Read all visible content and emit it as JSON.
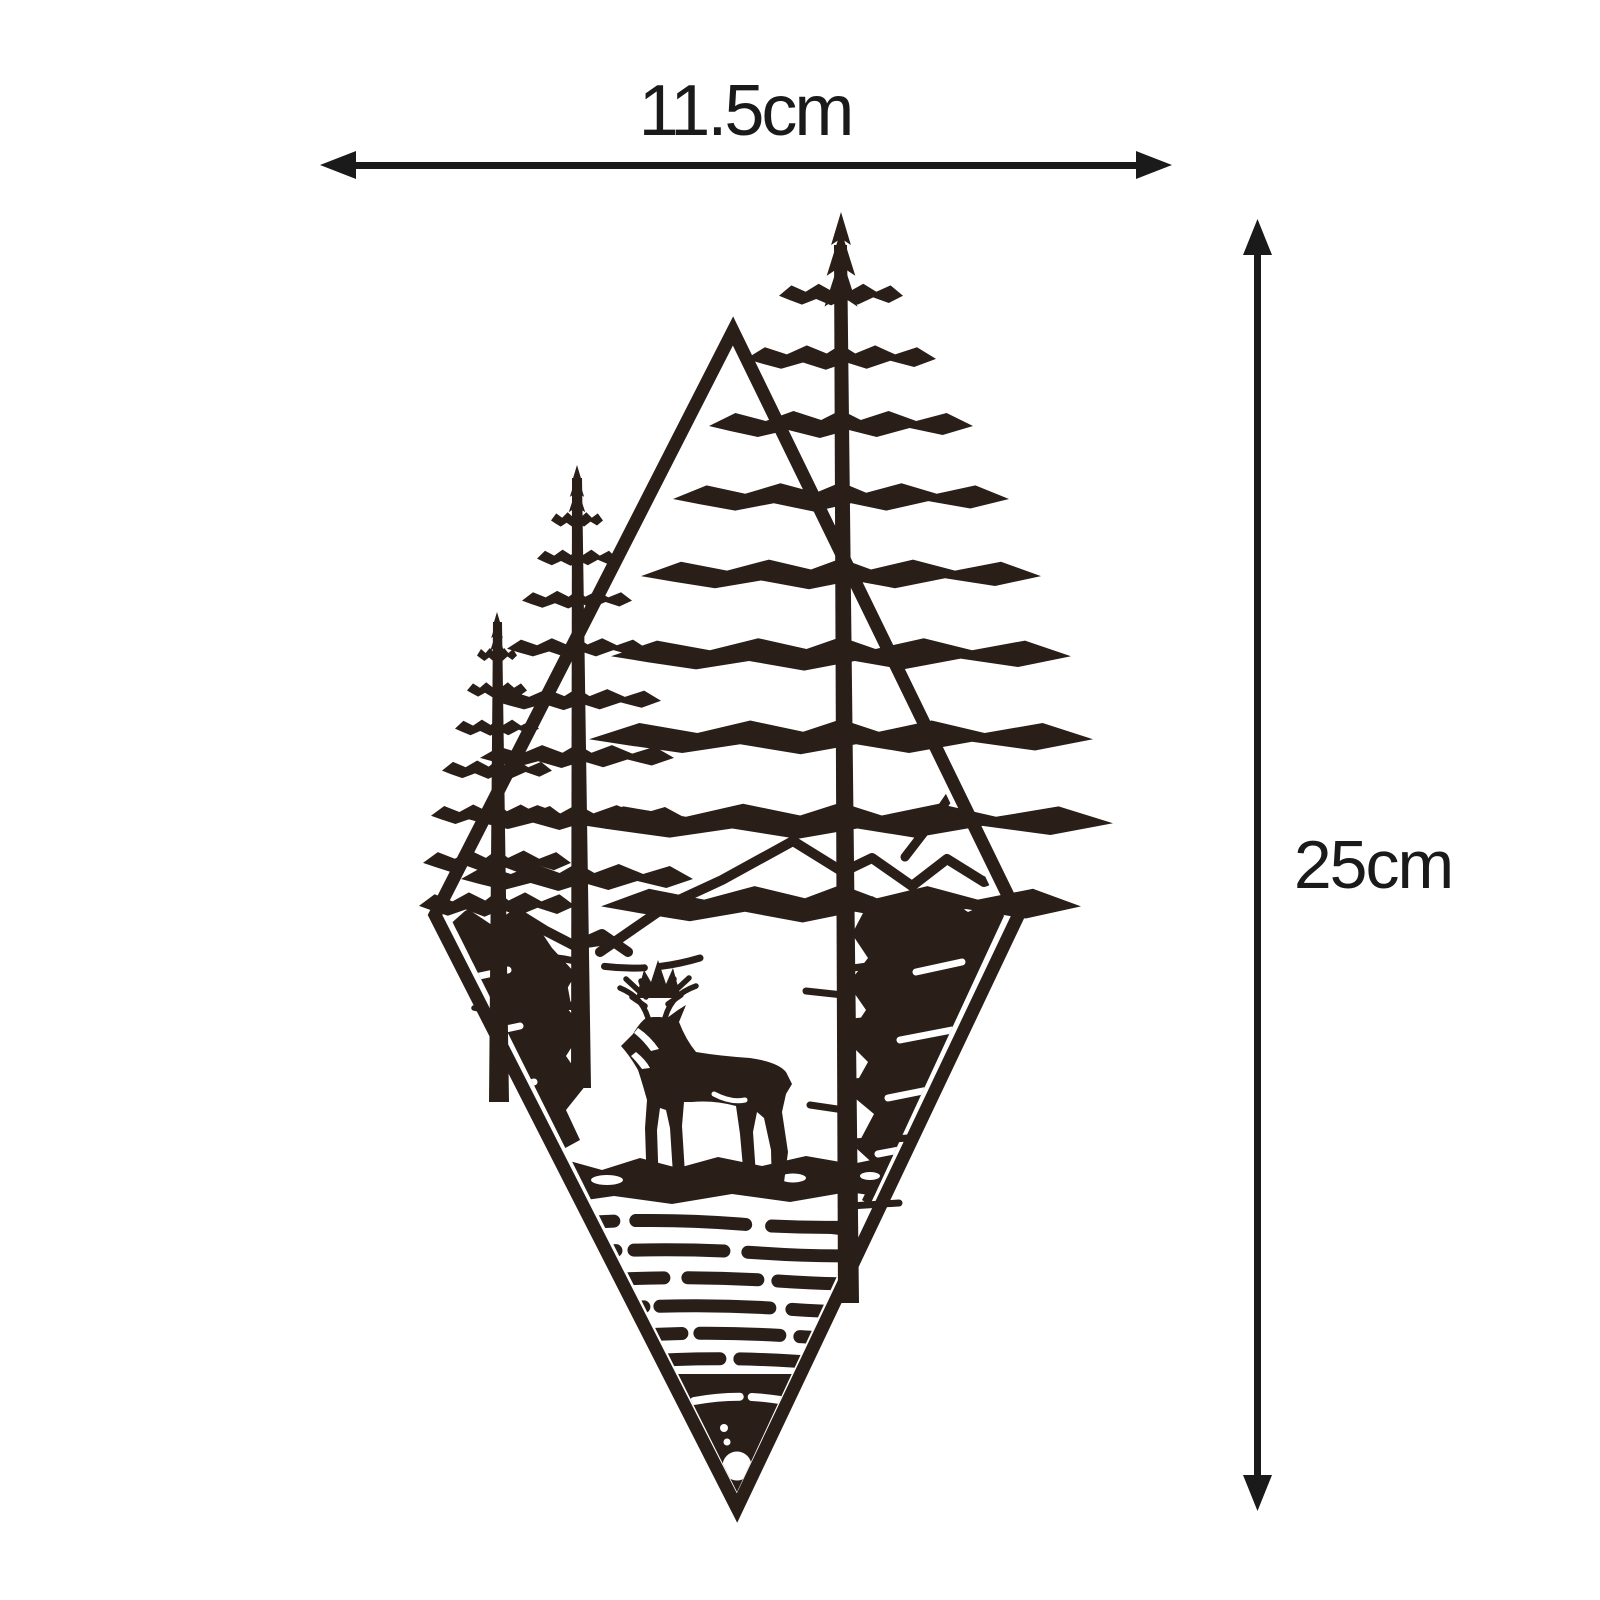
{
  "page": {
    "type": "product-dimension-diagram"
  },
  "colors": {
    "background": "#ffffff",
    "artwork": "#2a1f18",
    "dimension": "#1a1a1a",
    "cutout": "#ffffff"
  },
  "dimensions": {
    "width": {
      "label": "11.5cm"
    },
    "height": {
      "label": "25cm"
    }
  },
  "artwork": {
    "icons": [
      "diamond-frame-icon",
      "mountain-peak-icon",
      "pine-tree-icon",
      "deer-stag-icon",
      "bush-icon",
      "water-ripples-icon",
      "hanging-hole-icon"
    ]
  }
}
